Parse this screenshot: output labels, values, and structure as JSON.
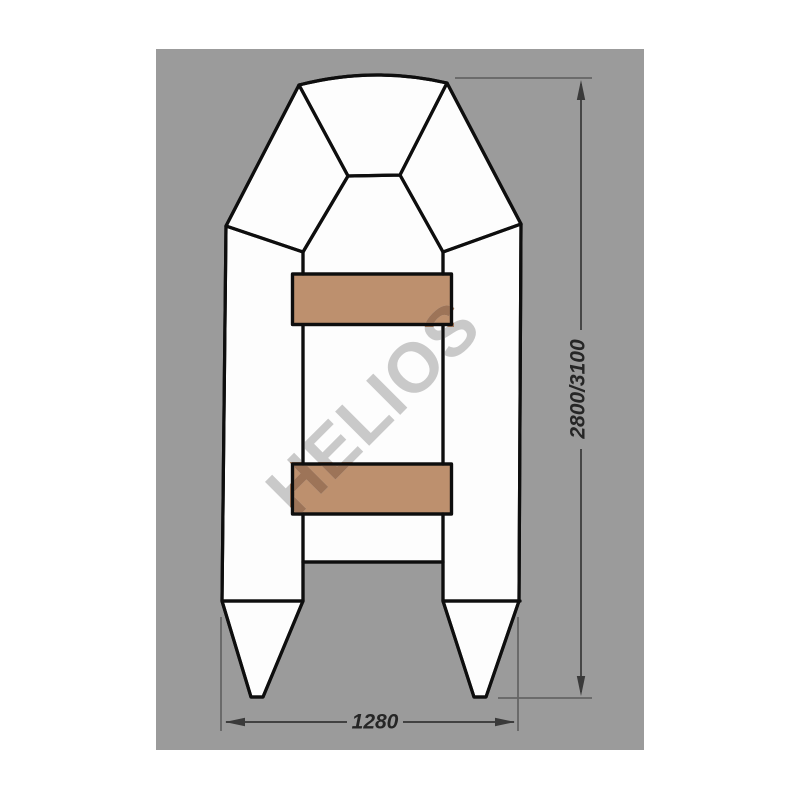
{
  "diagram": {
    "watermark_text": "HELIOS",
    "length_label": "2800/3100",
    "width_label": "1280",
    "colors": {
      "page_outside": "#ffffff",
      "canvas": "#9b9b9b",
      "boat_fill": "#fdfdfd",
      "outline": "#0e0e0e",
      "seat": "#bd906e",
      "watermark_light": "#c9c9c9",
      "watermark_on_seat": "#9d7458",
      "dimension_line": "#424242",
      "arrow": "#3a3a3a",
      "tick_line": "#646464",
      "label_color": "#262626"
    }
  }
}
